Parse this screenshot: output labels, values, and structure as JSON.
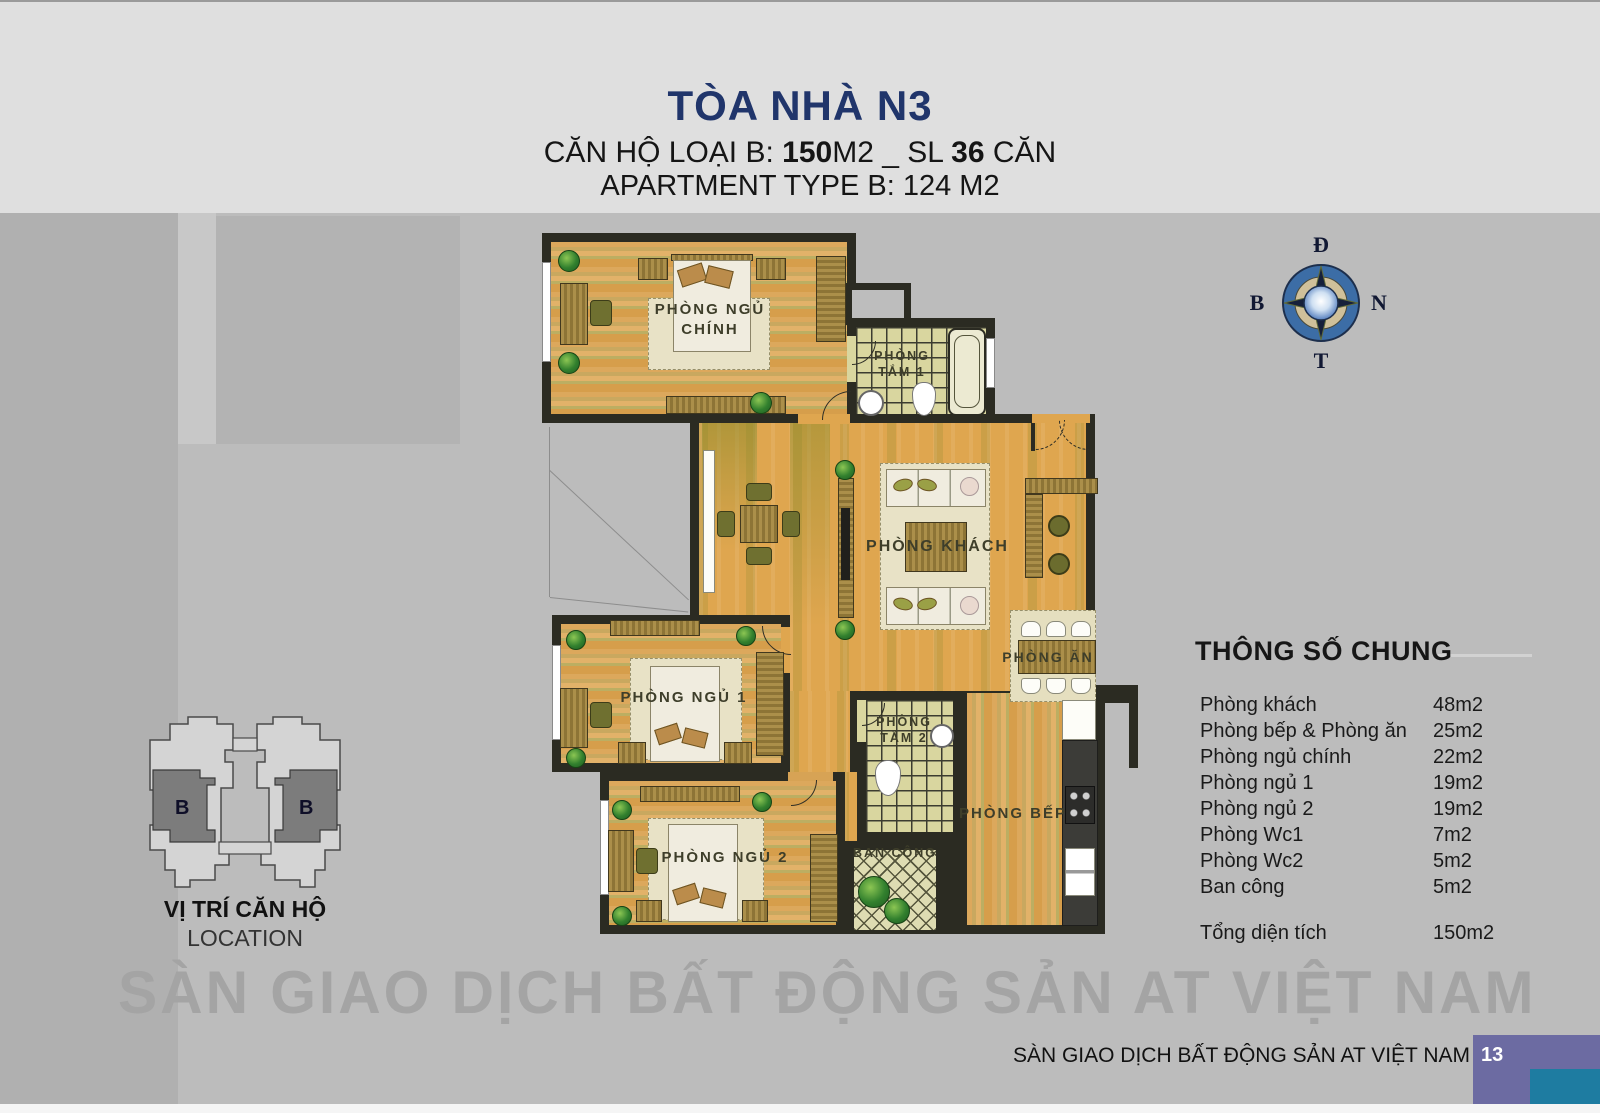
{
  "header": {
    "title": "TÒA NHÀ N3",
    "sub_pre": "CĂN HỘ LOẠI B: ",
    "sub_b1": "150",
    "sub_mid": "M2 _ SL ",
    "sub_b2": "36",
    "sub_post": " CĂN",
    "sub_en": "APARTMENT TYPE B: 124 M2"
  },
  "plan": {
    "rooms": {
      "master": "PHÒNG NGỦ\nCHÍNH",
      "bath1": "PHÒNG\nTẮM 1",
      "living": "PHÒNG KHÁCH",
      "dining": "PHÒNG ĂN",
      "bed1": "PHÒNG NGỦ 1",
      "bath2": "PHÒNG\nTẮM 2",
      "bed2": "PHÒNG NGỦ 2",
      "balcony": "BAN CÔNG",
      "kitchen": "PHÒNG BẾP"
    }
  },
  "compass": {
    "top": "Đ",
    "left": "B",
    "right": "N",
    "bottom": "T"
  },
  "location": {
    "title": "VỊ TRÍ CĂN HỘ",
    "subtitle": "LOCATION",
    "unit": "B"
  },
  "spec": {
    "title": "THÔNG SỐ CHUNG",
    "rows": [
      {
        "label": "Phòng khách",
        "value": "48m2"
      },
      {
        "label": "Phòng bếp & Phòng ăn",
        "value": "25m2"
      },
      {
        "label": "Phòng ngủ chính",
        "value": "22m2"
      },
      {
        "label": "Phòng ngủ 1",
        "value": "19m2"
      },
      {
        "label": "Phòng ngủ 2",
        "value": "19m2"
      },
      {
        "label": "Phòng Wc1",
        "value": "7m2"
      },
      {
        "label": "Phòng Wc2",
        "value": "5m2"
      },
      {
        "label": "Ban công",
        "value": "5m2"
      }
    ],
    "total": {
      "label": "Tổng diện tích",
      "value": "150m2"
    }
  },
  "watermark": "SÀN GIAO DỊCH BẤT ĐỘNG SẢN AT VIỆT NAM",
  "footer": {
    "text": "SÀN GIAO DỊCH BẤT ĐỘNG SẢN AT VIỆT NAM",
    "page": "13"
  },
  "colors": {
    "title_navy": "#20356b",
    "footer_purple": "#6c6ba2",
    "footer_teal": "#1e7ca1",
    "wall": "#2b2b22",
    "living_orange": "#dfa64f",
    "wood": "#d7a355",
    "tile": "#d9d69f"
  }
}
